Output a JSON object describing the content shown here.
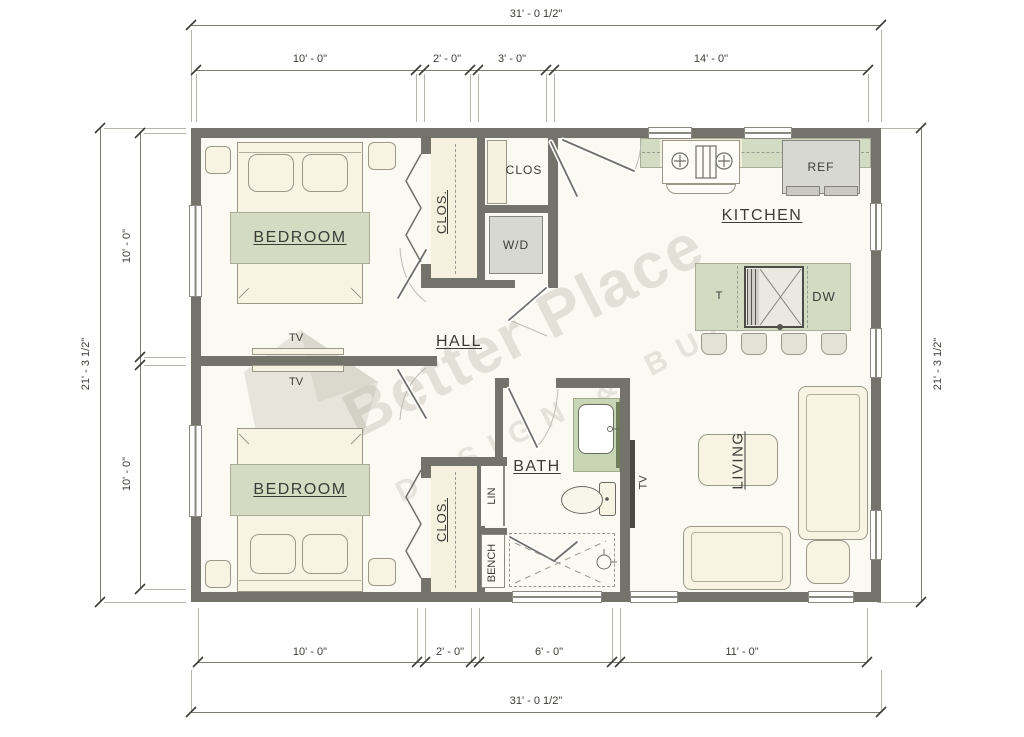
{
  "watermark": {
    "brand": "Better Place",
    "tagline": "DESIGN & BUILD"
  },
  "dims": {
    "top_total": "31' - 0 1/2\"",
    "top_segs": [
      "10' - 0\"",
      "2' - 0\"",
      "3' - 0\"",
      "14' - 0\""
    ],
    "bottom_segs": [
      "10' - 0\"",
      "2' - 0\"",
      "6' - 0\"",
      "11' - 0\""
    ],
    "bottom_total": "31' - 0 1/2\"",
    "left_total": "21' - 3 1/2\"",
    "left_segs": [
      "10' - 0\"",
      "10' - 0\""
    ],
    "right_total": "21' - 3 1/2\""
  },
  "rooms": {
    "bedroom1": "BEDROOM",
    "bedroom2": "BEDROOM",
    "closet1": "CLOS.",
    "closet2": "CLOS.",
    "entry_closet": "CLOS",
    "hall": "HALL",
    "kitchen": "KITCHEN",
    "bath": "BATH",
    "living": "LIVING",
    "linen": "LIN",
    "bench": "BENCH"
  },
  "fixtures": {
    "washer_dryer": "W/D",
    "refrigerator": "REF",
    "dishwasher": "DW",
    "trash": "T",
    "tv_bedroom1": "TV",
    "tv_bedroom2": "TV",
    "tv_living": "TV"
  }
}
